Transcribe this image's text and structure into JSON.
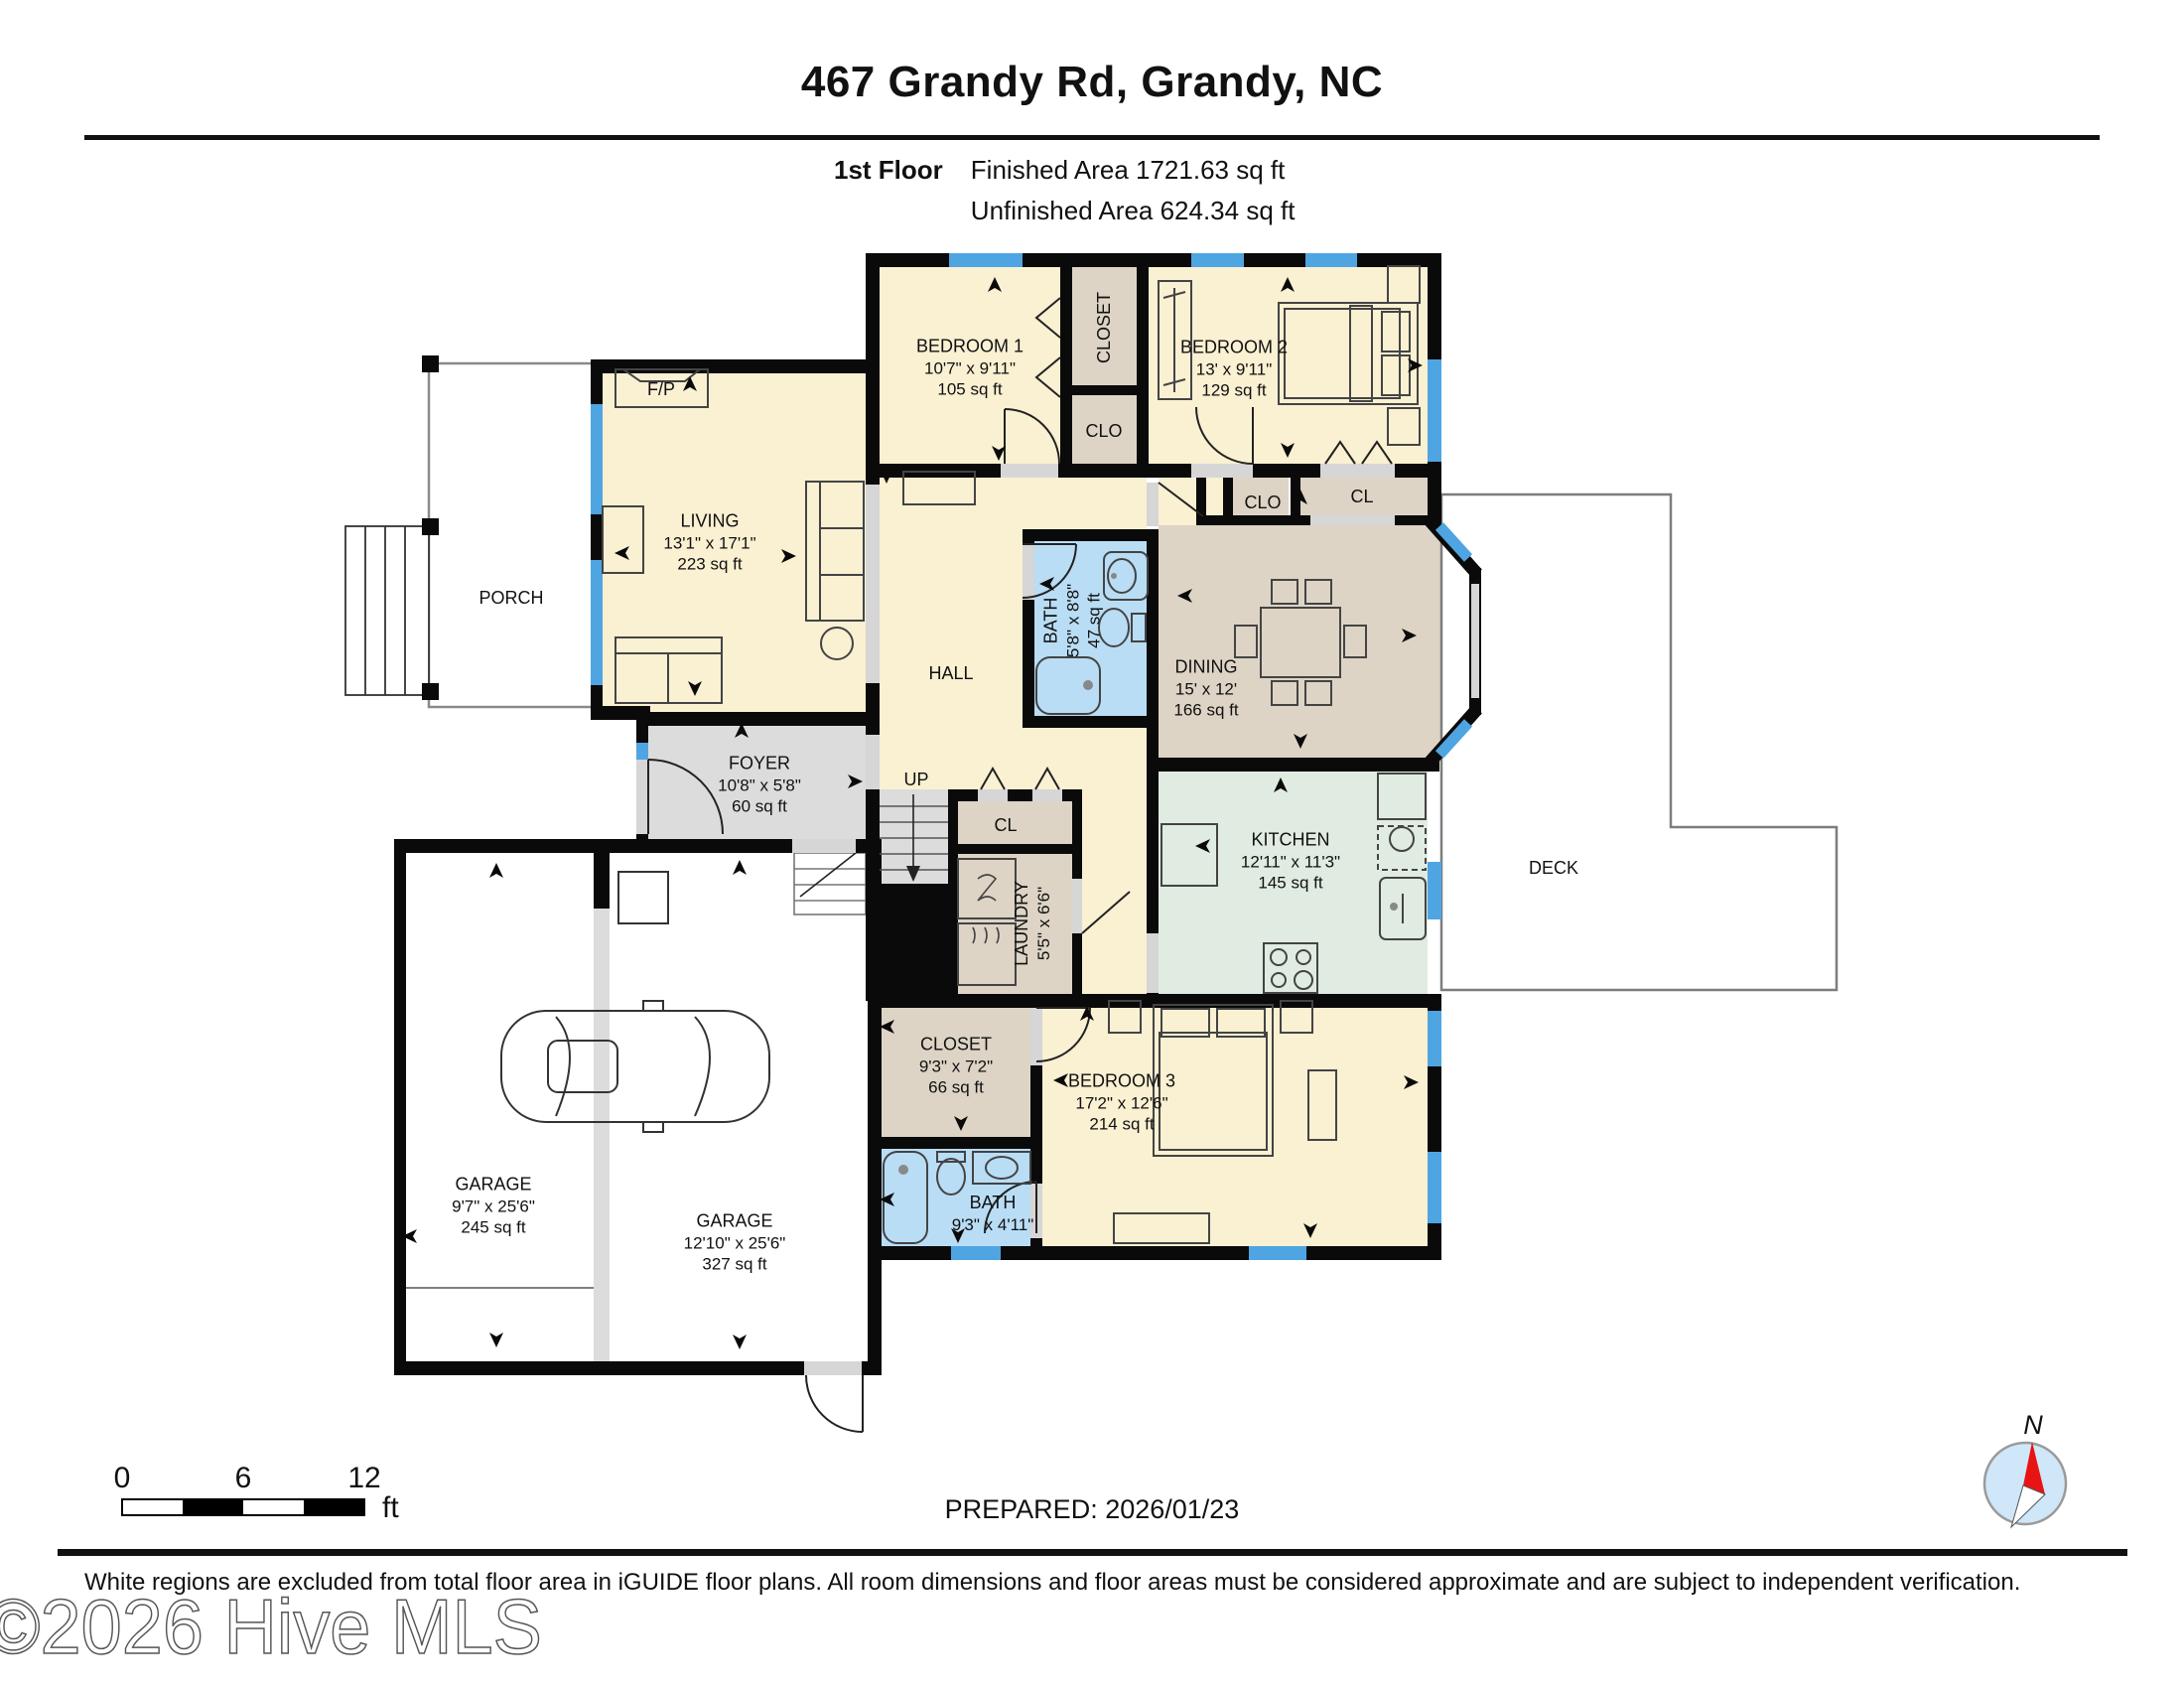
{
  "header": {
    "title": "467 Grandy Rd, Grandy, NC",
    "floor_label": "1st Floor",
    "finished": "Finished Area 1721.63 sq ft",
    "unfinished": "Unfinished Area 624.34 sq ft"
  },
  "rooms": {
    "bedroom1": {
      "name": "BEDROOM 1",
      "dims": "10'7\" x 9'11\"",
      "area": "105 sq ft"
    },
    "bedroom2": {
      "name": "BEDROOM 2",
      "dims": "13' x 9'11\"",
      "area": "129 sq ft"
    },
    "bedroom3": {
      "name": "BEDROOM 3",
      "dims": "17'2\" x 12'6\"",
      "area": "214 sq ft"
    },
    "living": {
      "name": "LIVING",
      "dims": "13'1\" x 17'1\"",
      "area": "223 sq ft"
    },
    "dining": {
      "name": "DINING",
      "dims": "15' x 12'",
      "area": "166 sq ft"
    },
    "kitchen": {
      "name": "KITCHEN",
      "dims": "12'11\" x 11'3\"",
      "area": "145 sq ft"
    },
    "foyer": {
      "name": "FOYER",
      "dims": "10'8\" x 5'8\"",
      "area": "60 sq ft"
    },
    "bath1": {
      "name": "BATH",
      "dims": "5'8\" x 8'8\"",
      "area": "47 sq ft"
    },
    "bath2": {
      "name": "BATH",
      "dims": "9'3\" x 4'11\""
    },
    "laundry": {
      "name": "LAUNDRY",
      "dims": "5'5\" x 6'6\""
    },
    "closet2": {
      "name": "CLOSET",
      "dims": "9'3\" x 7'2\"",
      "area": "66 sq ft"
    },
    "garage1": {
      "name": "GARAGE",
      "dims": "9'7\" x 25'6\"",
      "area": "245 sq ft"
    },
    "garage2": {
      "name": "GARAGE",
      "dims": "12'10\" x 25'6\"",
      "area": "327 sq ft"
    }
  },
  "labels": {
    "hall": "HALL",
    "porch": "PORCH",
    "deck": "DECK",
    "up": "UP",
    "fp": "F/P",
    "closet_top": "CLOSET",
    "clo_top": "CLO",
    "clo_dining": "CLO",
    "cl_dining": "CL",
    "cl_stairs": "CL"
  },
  "scale_bar": {
    "t0": "0",
    "t6": "6",
    "t12": "12",
    "unit": "ft"
  },
  "compass": {
    "north": "N"
  },
  "footer": {
    "prepared": "PREPARED: 2026/01/23",
    "disclaimer": "White regions are excluded from total floor area in iGUIDE floor plans. All room dimensions and floor areas must be considered approximate and are subject to independent verification.",
    "watermark": "©2026 Hive MLS"
  },
  "colors": {
    "room_cream": "#faf0d2",
    "room_tan": "#ddd4c5",
    "room_blue": "#b9ddf5",
    "room_green": "#e0ebe1",
    "floor_gray": "#dcdcdc",
    "window_blue": "#4fa5e2",
    "wall_black": "#0a0a0a"
  }
}
